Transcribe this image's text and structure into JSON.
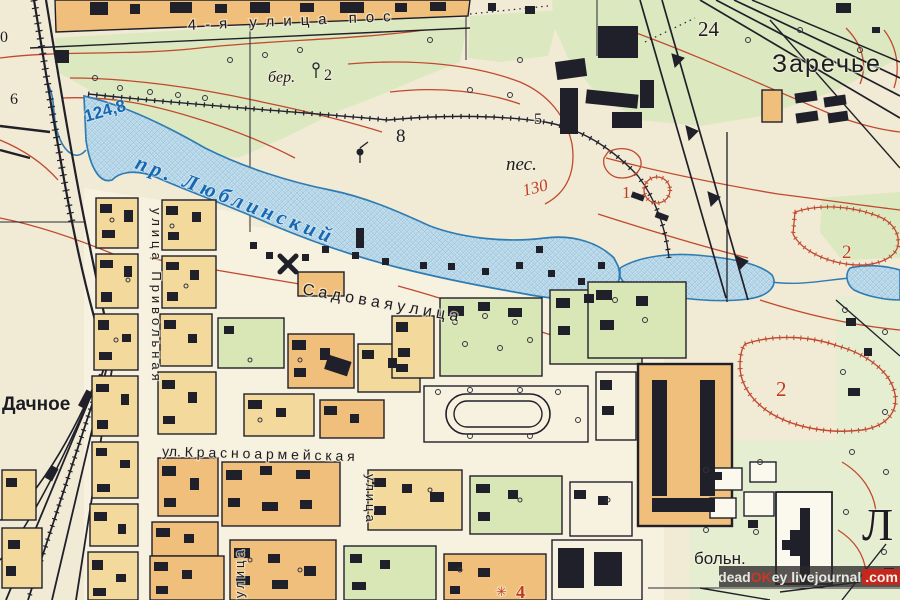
{
  "map": {
    "hydro": {
      "pond_name": "пр. Люблинский",
      "water_elevation": "124,8"
    },
    "places": {
      "zarechye": "Заречье",
      "dachnoye": "Дачное",
      "hospital_abbrev": "больн.",
      "big_letter": "Л",
      "sand": "пес.",
      "birch_note": "бер.",
      "birch_note_num": "2"
    },
    "streets": {
      "top_street": "4-я улица пос",
      "sadovaya": "С а д о в а я   у л и ц а",
      "krasnoarmeyskaya": "ул. К р а с н о а р м е й с к а я",
      "privolnaya_vertical": "улица Привольная",
      "ulitsa_sw_vertical": "улица",
      "ulitsa_s_vertical": "улица"
    },
    "numbers": {
      "contour_130": "130",
      "n24": "24",
      "n8": "8",
      "n5": "5",
      "n6": "6",
      "n0": "0",
      "n1_quarry": "1",
      "n2_quarry_east": "2",
      "n2_quarry_south": "2",
      "n4_landmark": "4",
      "star_glyph": "✳"
    },
    "watermark": {
      "full": "deadOKey.livejournal.com",
      "dead": "dead",
      "ok": "OK",
      "ey": "ey",
      "dot": ".",
      "livejournal": "livejournal",
      "com": ".com"
    },
    "colors": {
      "paper": "#f1ead4",
      "city_paper": "#f7f1e0",
      "veg": "#dce8c0",
      "veg_light": "#e6eed2",
      "water": "#c9e2ef",
      "water_line": "#2f7cb4",
      "water_text": "#1668b2",
      "contour": "#c0492f",
      "label_red": "#c03a22",
      "block_orange": "#f1bf7c",
      "block_yellow": "#f3d99b",
      "block_green": "#d9e6b5",
      "ink": "#20202a"
    }
  }
}
